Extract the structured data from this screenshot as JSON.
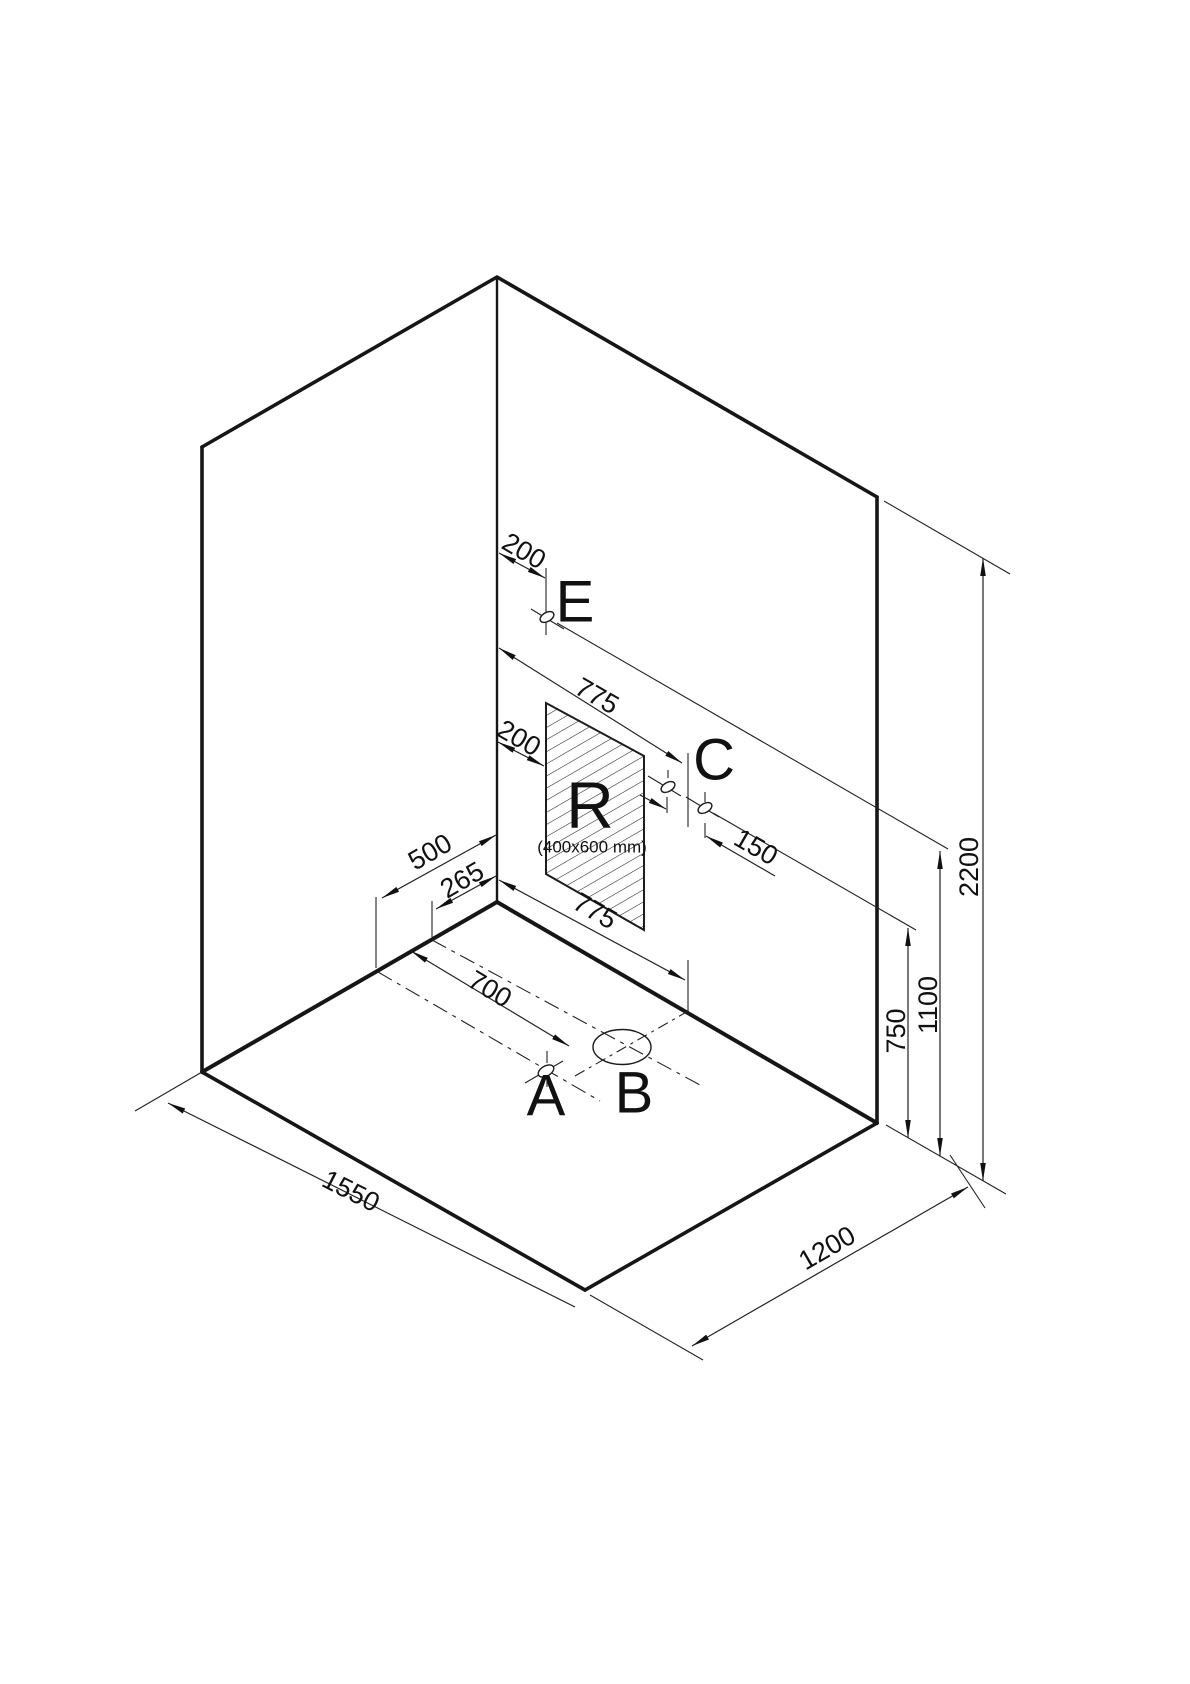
{
  "drawing": {
    "description": "Isometric installation drawing of a room corner (two walls and floor) with a hatched wall recess R and connection points A, B, C, E",
    "points": {
      "a": "A",
      "b": "B",
      "c": "C",
      "e": "E",
      "recess": "R",
      "recess_size": "(400x600 mm)"
    },
    "dimensions": {
      "room_width": "1550",
      "room_depth": "1200",
      "room_height": "2200",
      "height_e": "1100",
      "height_c": "750",
      "wall_775_top": "775",
      "wall_775_bottom": "775",
      "offset_e_from_corner": "200",
      "offset_recess_from_corner": "200",
      "spacing_c": "150",
      "floor_offset_a": "500",
      "floor_offset_b": "265",
      "floor_distance_a": "700"
    },
    "colors": {
      "line": "#161616",
      "background": "#ffffff"
    }
  }
}
